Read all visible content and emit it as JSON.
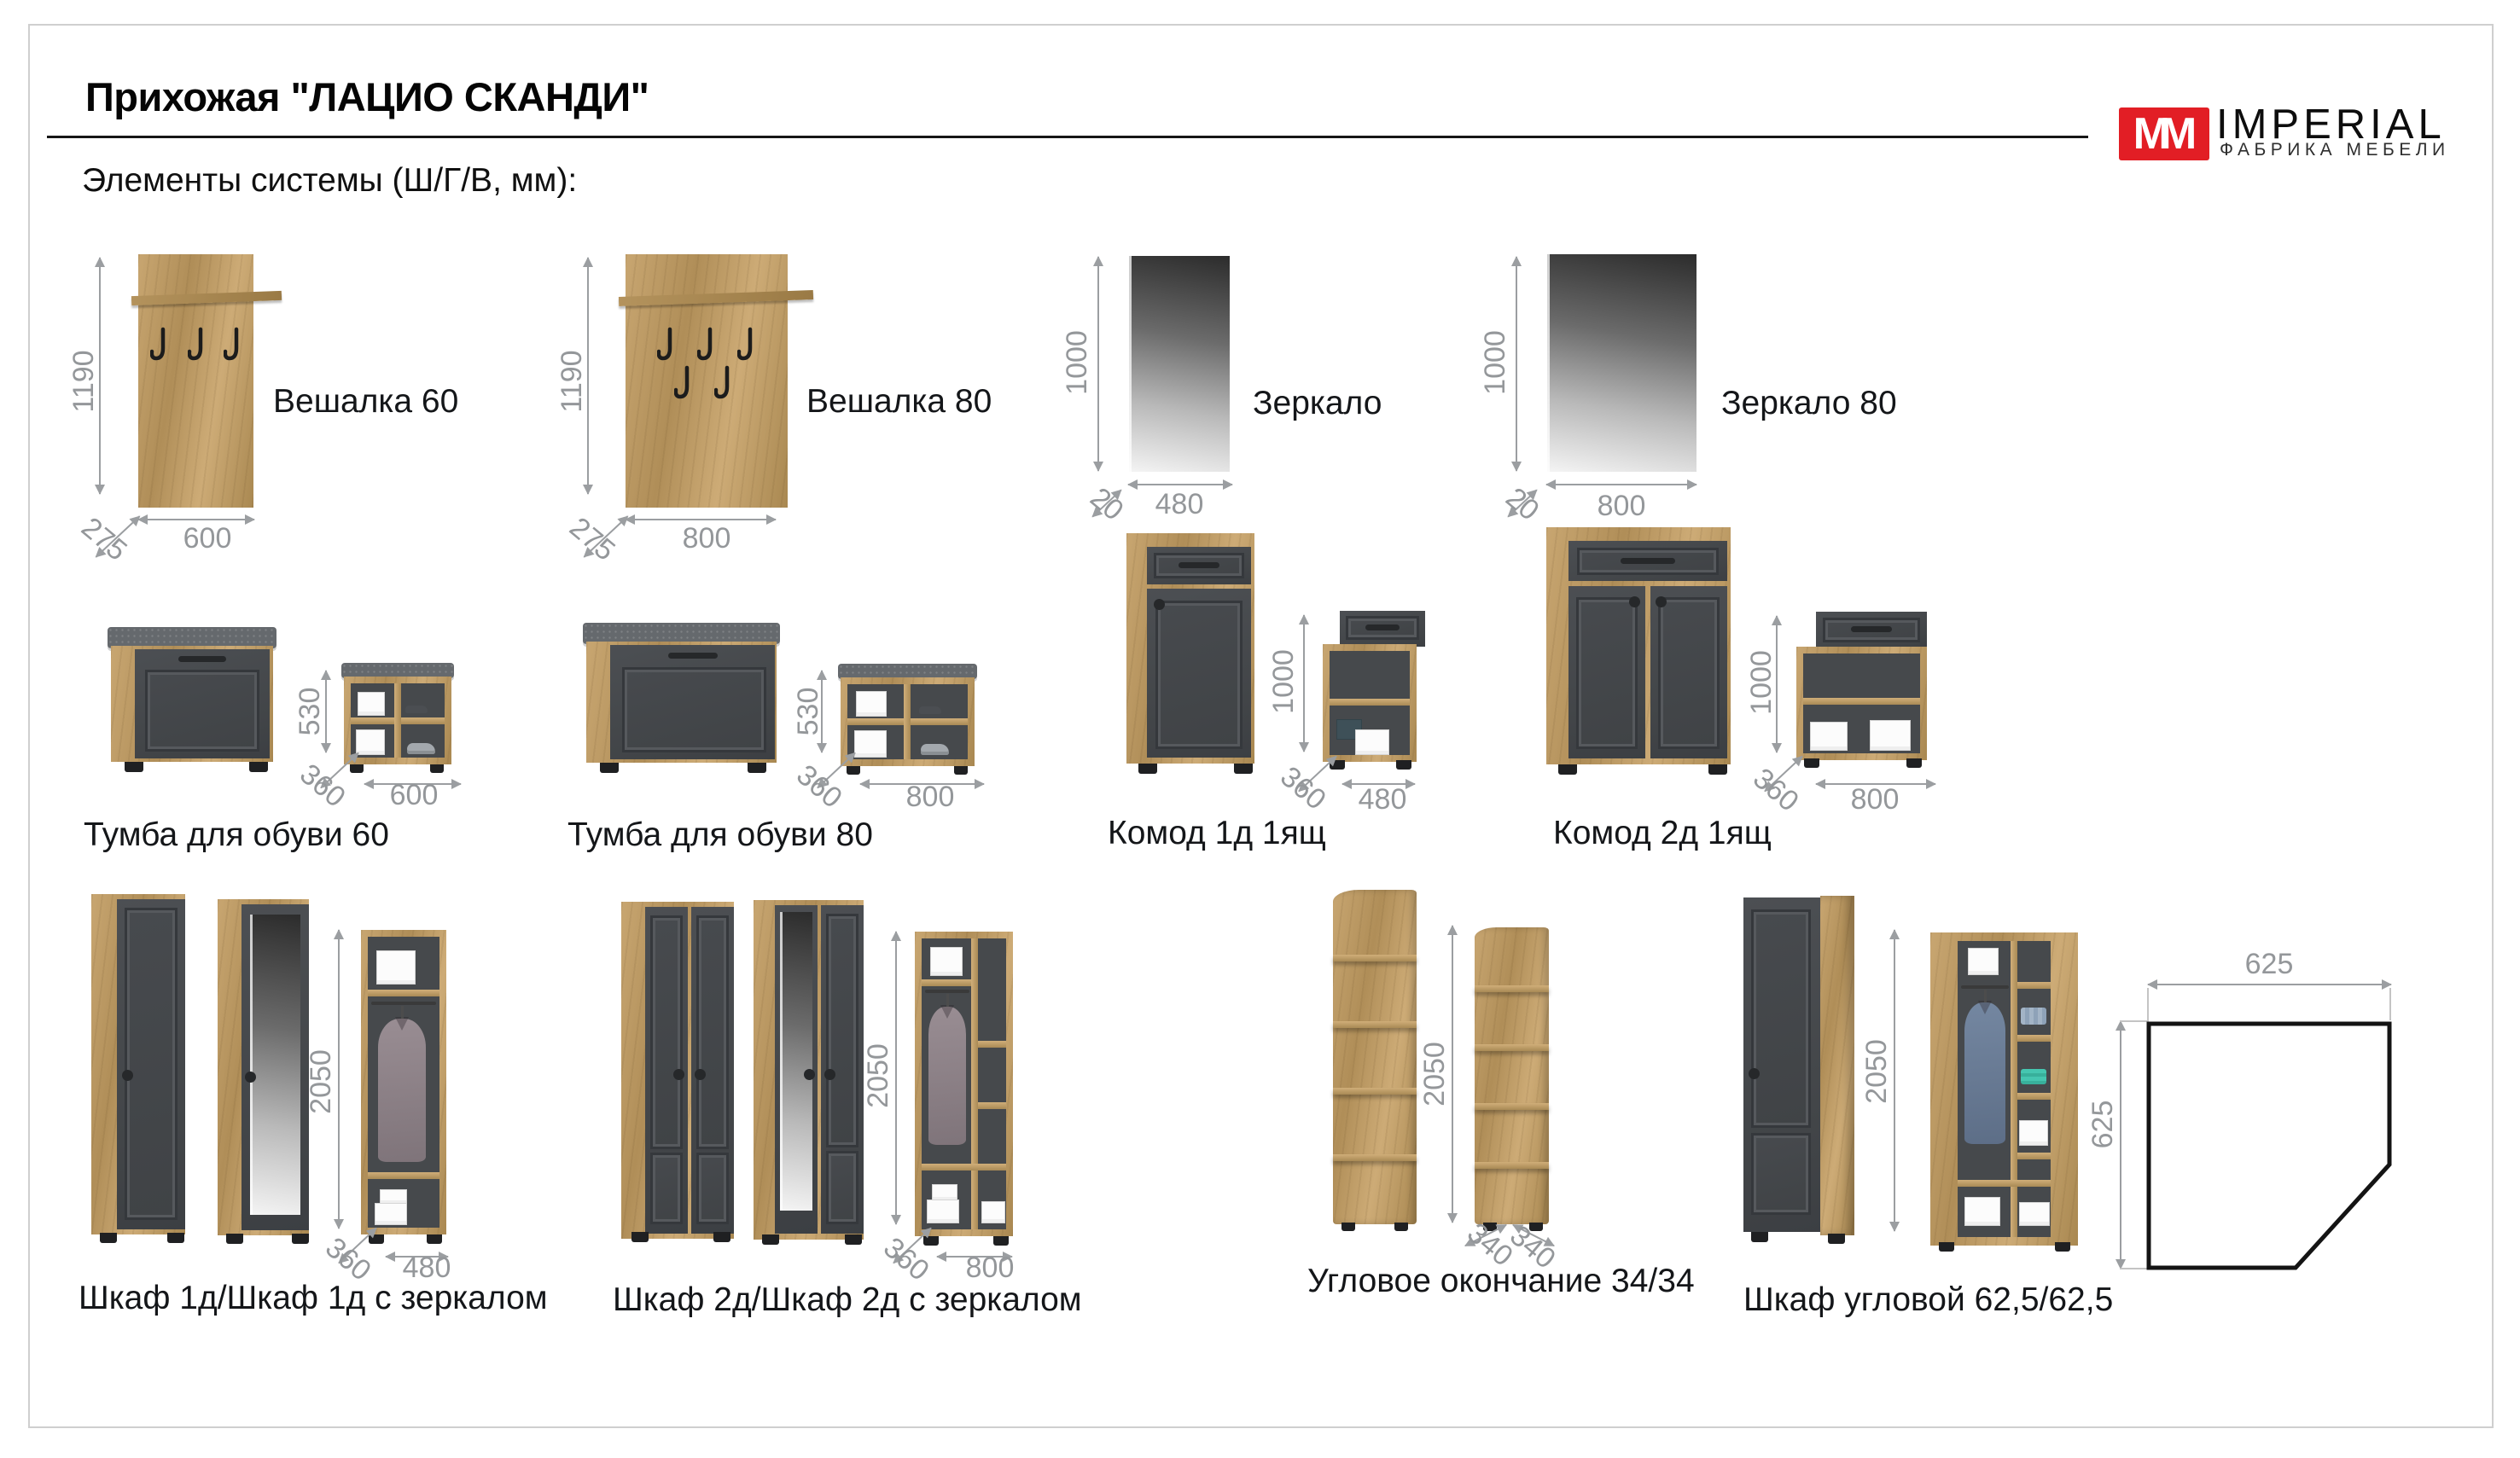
{
  "page": {
    "title": "Прихожая \"ЛАЦИО СКАНДИ\"",
    "subtitle": "Элементы системы (Ш/Г/В, мм):"
  },
  "logo": {
    "mark": "MM",
    "name": "IMPERIAL",
    "tagline": "ФАБРИКА МЕБЕЛИ",
    "accent_color": "#e21e25"
  },
  "colors": {
    "wood": "#b08e58",
    "front_dark": "#46494d",
    "dimension_grey": "#9b9ea1",
    "cushion_grey": "#65696d"
  },
  "products": [
    {
      "id": "veshalka-60",
      "label": "Вешалка 60",
      "height": "1190",
      "depth": "275",
      "width": "600"
    },
    {
      "id": "veshalka-80",
      "label": "Вешалка 80",
      "height": "1190",
      "depth": "275",
      "width": "800"
    },
    {
      "id": "zerkalo",
      "label": "Зеркало",
      "height": "1000",
      "depth": "20",
      "width": "480"
    },
    {
      "id": "zerkalo-80",
      "label": "Зеркало 80",
      "height": "1000",
      "depth": "20",
      "width": "800"
    },
    {
      "id": "tumba-dlya-obuvi-60",
      "label": "Тумба для обуви 60",
      "height": "530",
      "depth": "360",
      "width": "600"
    },
    {
      "id": "tumba-dlya-obuvi-80",
      "label": "Тумба для обуви 80",
      "height": "530",
      "depth": "360",
      "width": "800"
    },
    {
      "id": "komod-1d-1yashch",
      "label": "Комод 1д 1ящ",
      "height": "1000",
      "depth": "360",
      "width": "480"
    },
    {
      "id": "komod-2d-1yashch",
      "label": "Комод 2д 1ящ",
      "height": "1000",
      "depth": "360",
      "width": "800"
    },
    {
      "id": "shkaf-1d",
      "label": "Шкаф 1д/Шкаф 1д с зеркалом",
      "height": "2050",
      "depth": "360",
      "width": "480"
    },
    {
      "id": "shkaf-2d",
      "label": "Шкаф 2д/Шкаф 2д с зеркалом",
      "height": "2050",
      "depth": "360",
      "width": "800"
    },
    {
      "id": "uglovoe-okonchanie",
      "label": "Угловое окончание 34/34",
      "height": "2050",
      "width_left": "340",
      "width_right": "340"
    },
    {
      "id": "shkaf-uglovoy",
      "label": "Шкаф угловой 62,5/62,5",
      "height": "2050",
      "plan_width": "625",
      "plan_depth": "625"
    }
  ]
}
